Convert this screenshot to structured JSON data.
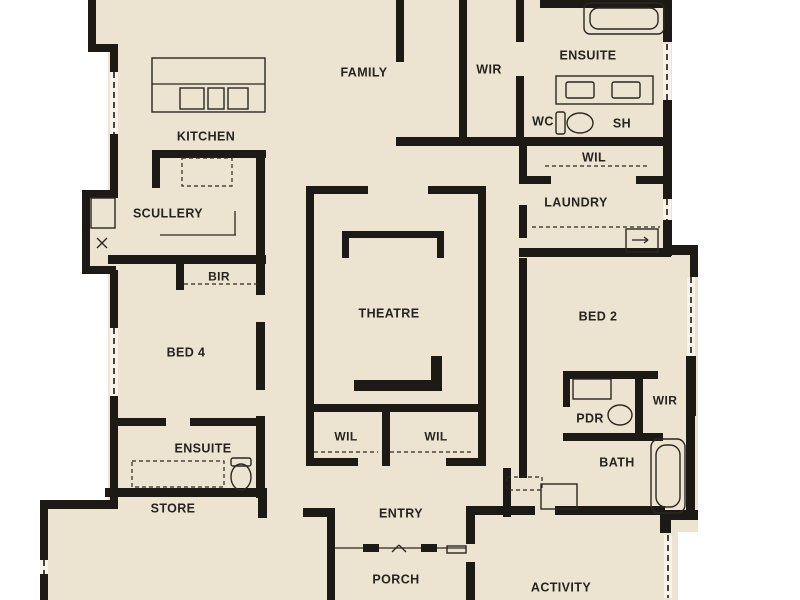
{
  "title": "Residential floor plan",
  "palette": {
    "page_bg": "#ffffff",
    "floor": "#ece4d1",
    "wall": "#1d1a15",
    "label": "#272320",
    "fixture": "#2b2620",
    "window_bg": "#f7f3ea"
  },
  "rooms": [
    {
      "id": "family",
      "label": "FAMILY",
      "x": 364,
      "y": 72,
      "size": 12.5
    },
    {
      "id": "wir-top",
      "label": "WIR",
      "x": 489,
      "y": 69,
      "size": 12.5
    },
    {
      "id": "ensuite-top",
      "label": "ENSUITE",
      "x": 588,
      "y": 55,
      "size": 12.5
    },
    {
      "id": "wc",
      "label": "WC",
      "x": 543,
      "y": 121,
      "size": 12.5
    },
    {
      "id": "sh",
      "label": "SH",
      "x": 622,
      "y": 123,
      "size": 12.5
    },
    {
      "id": "wil-top",
      "label": "WIL",
      "x": 594,
      "y": 157,
      "size": 12.5
    },
    {
      "id": "laundry",
      "label": "LAUNDRY",
      "x": 576,
      "y": 202,
      "size": 12.5
    },
    {
      "id": "kitchen",
      "label": "KITCHEN",
      "x": 206,
      "y": 136,
      "size": 12.5
    },
    {
      "id": "scullery",
      "label": "SCULLERY",
      "x": 168,
      "y": 213,
      "size": 12.5
    },
    {
      "id": "bir",
      "label": "BIR",
      "x": 219,
      "y": 276,
      "size": 12
    },
    {
      "id": "theatre",
      "label": "THEATRE",
      "x": 389,
      "y": 313,
      "size": 12.5
    },
    {
      "id": "bed2",
      "label": "BED 2",
      "x": 598,
      "y": 316,
      "size": 12.5
    },
    {
      "id": "bed4",
      "label": "BED 4",
      "x": 186,
      "y": 352,
      "size": 12.5
    },
    {
      "id": "wir-right",
      "label": "WIR",
      "x": 665,
      "y": 400,
      "size": 12
    },
    {
      "id": "pdr",
      "label": "PDR",
      "x": 590,
      "y": 418,
      "size": 12.5
    },
    {
      "id": "ensuite-left",
      "label": "ENSUITE",
      "x": 203,
      "y": 448,
      "size": 12.5
    },
    {
      "id": "wil-left",
      "label": "WIL",
      "x": 346,
      "y": 436,
      "size": 12
    },
    {
      "id": "wil-right",
      "label": "WIL",
      "x": 436,
      "y": 436,
      "size": 12
    },
    {
      "id": "bath",
      "label": "BATH",
      "x": 617,
      "y": 462,
      "size": 12.5
    },
    {
      "id": "store",
      "label": "STORE",
      "x": 173,
      "y": 508,
      "size": 12.5
    },
    {
      "id": "entry",
      "label": "ENTRY",
      "x": 401,
      "y": 513,
      "size": 12.5
    },
    {
      "id": "porch",
      "label": "PORCH",
      "x": 396,
      "y": 579,
      "size": 12.5
    },
    {
      "id": "activity",
      "label": "ACTIVITY",
      "x": 561,
      "y": 587,
      "size": 12.5
    }
  ],
  "floorplan": {
    "floor": [
      [
        92,
        0,
        24,
        52
      ],
      [
        108,
        0,
        564,
        510
      ],
      [
        84,
        192,
        26,
        82
      ],
      [
        672,
        247,
        26,
        285
      ],
      [
        40,
        502,
        295,
        98
      ],
      [
        330,
        510,
        140,
        90
      ],
      [
        466,
        506,
        212,
        94
      ]
    ],
    "walls": [
      [
        88,
        0,
        8,
        50
      ],
      [
        88,
        44,
        30,
        8
      ],
      [
        110,
        48,
        8,
        24
      ],
      [
        110,
        134,
        8,
        64
      ],
      [
        82,
        190,
        34,
        8
      ],
      [
        82,
        190,
        8,
        83
      ],
      [
        82,
        266,
        34,
        8
      ],
      [
        110,
        270,
        8,
        58
      ],
      [
        110,
        396,
        8,
        110
      ],
      [
        40,
        500,
        78,
        9
      ],
      [
        40,
        500,
        8,
        60
      ],
      [
        40,
        574,
        8,
        26
      ],
      [
        327,
        508,
        8,
        92
      ],
      [
        303,
        508,
        32,
        9
      ],
      [
        396,
        0,
        8,
        62
      ],
      [
        459,
        0,
        8,
        145
      ],
      [
        516,
        0,
        8,
        42
      ],
      [
        516,
        76,
        8,
        69
      ],
      [
        540,
        0,
        132,
        8
      ],
      [
        663,
        0,
        9,
        42
      ],
      [
        663,
        100,
        9,
        45
      ],
      [
        396,
        137,
        276,
        9
      ],
      [
        519,
        145,
        8,
        38
      ],
      [
        519,
        176,
        32,
        8
      ],
      [
        636,
        176,
        32,
        8
      ],
      [
        663,
        145,
        9,
        54
      ],
      [
        663,
        220,
        9,
        36
      ],
      [
        519,
        205,
        8,
        33
      ],
      [
        519,
        248,
        152,
        9
      ],
      [
        664,
        245,
        34,
        10
      ],
      [
        690,
        245,
        8,
        32
      ],
      [
        686,
        356,
        10,
        60
      ],
      [
        686,
        412,
        9,
        104
      ],
      [
        660,
        510,
        38,
        10
      ],
      [
        660,
        513,
        11,
        20
      ],
      [
        519,
        258,
        8,
        220
      ],
      [
        563,
        371,
        7,
        36
      ],
      [
        563,
        371,
        95,
        8
      ],
      [
        635,
        375,
        8,
        64
      ],
      [
        563,
        433,
        100,
        8
      ],
      [
        503,
        468,
        8,
        49
      ],
      [
        503,
        506,
        32,
        9
      ],
      [
        555,
        506,
        110,
        9
      ],
      [
        466,
        506,
        64,
        9
      ],
      [
        466,
        506,
        9,
        38
      ],
      [
        466,
        562,
        9,
        38
      ],
      [
        306,
        186,
        8,
        280
      ],
      [
        306,
        186,
        62,
        8
      ],
      [
        428,
        186,
        58,
        8
      ],
      [
        478,
        186,
        8,
        280
      ],
      [
        306,
        404,
        180,
        8
      ],
      [
        382,
        412,
        8,
        54
      ],
      [
        306,
        458,
        52,
        8
      ],
      [
        446,
        458,
        40,
        8
      ],
      [
        354,
        380,
        86,
        11
      ],
      [
        431,
        356,
        11,
        35
      ],
      [
        342,
        231,
        102,
        7
      ],
      [
        342,
        231,
        7,
        27
      ],
      [
        437,
        231,
        7,
        27
      ],
      [
        256,
        150,
        9,
        145
      ],
      [
        256,
        322,
        9,
        68
      ],
      [
        256,
        416,
        9,
        82
      ],
      [
        152,
        150,
        114,
        8
      ],
      [
        152,
        150,
        8,
        38
      ],
      [
        108,
        255,
        158,
        9
      ],
      [
        176,
        262,
        8,
        28
      ],
      [
        110,
        418,
        56,
        8
      ],
      [
        190,
        418,
        75,
        8
      ],
      [
        105,
        488,
        162,
        9
      ],
      [
        258,
        488,
        9,
        30
      ]
    ],
    "windows": [
      [
        114,
        72,
        114,
        136
      ],
      [
        114,
        328,
        114,
        398
      ],
      [
        44,
        560,
        44,
        576
      ],
      [
        667,
        44,
        667,
        100
      ],
      [
        667,
        199,
        667,
        222
      ],
      [
        691,
        277,
        691,
        356
      ],
      [
        668,
        535,
        668,
        598
      ]
    ],
    "fixture_rects": [
      [
        152,
        58,
        113,
        54,
        0
      ],
      [
        180,
        88,
        24,
        21,
        0
      ],
      [
        208,
        88,
        16,
        21,
        0
      ],
      [
        228,
        88,
        20,
        21,
        0
      ],
      [
        584,
        3,
        80,
        31,
        6
      ],
      [
        590,
        8,
        68,
        21,
        8
      ],
      [
        556,
        76,
        97,
        28,
        0
      ],
      [
        566,
        82,
        28,
        16,
        2
      ],
      [
        612,
        82,
        28,
        16,
        2
      ],
      [
        626,
        229,
        32,
        23,
        0
      ],
      [
        573,
        379,
        38,
        20,
        0
      ],
      [
        651,
        439,
        34,
        74,
        8
      ],
      [
        656,
        445,
        24,
        62,
        10
      ],
      [
        541,
        484,
        36,
        25,
        0
      ],
      [
        91,
        198,
        24,
        30,
        0
      ],
      [
        556,
        112,
        9,
        22,
        2
      ],
      [
        231,
        458,
        20,
        8,
        2
      ],
      [
        447,
        546,
        19,
        7,
        0
      ]
    ],
    "dashed_rects": [
      [
        182,
        158,
        50,
        28
      ],
      [
        132,
        461,
        92,
        26
      ],
      [
        507,
        477,
        35,
        13
      ]
    ],
    "lines": [
      [
        152,
        84,
        265,
        84
      ],
      [
        160,
        235,
        236,
        235
      ],
      [
        235,
        211,
        235,
        235
      ],
      [
        335,
        548,
        466,
        548
      ],
      [
        392,
        552,
        399,
        545
      ],
      [
        399,
        545,
        406,
        552
      ],
      [
        632,
        240,
        648,
        240
      ],
      [
        644,
        237,
        648,
        240
      ],
      [
        648,
        240,
        644,
        243
      ],
      [
        97,
        238,
        107,
        248
      ],
      [
        107,
        238,
        97,
        248
      ]
    ],
    "dashed_lines": [
      [
        545,
        166,
        648,
        166
      ],
      [
        314,
        452,
        378,
        452
      ],
      [
        390,
        452,
        474,
        452
      ],
      [
        184,
        284,
        258,
        284
      ],
      [
        532,
        227,
        660,
        227
      ]
    ],
    "ellipses": [
      {
        "cx": 580,
        "cy": 123,
        "rx": 13,
        "ry": 10
      },
      {
        "cx": 620,
        "cy": 415,
        "rx": 12,
        "ry": 10
      },
      {
        "cx": 241,
        "cy": 477,
        "rx": 10,
        "ry": 13
      }
    ],
    "door_leaves": [
      [
        363,
        544,
        16,
        8
      ],
      [
        421,
        544,
        16,
        8
      ]
    ]
  }
}
